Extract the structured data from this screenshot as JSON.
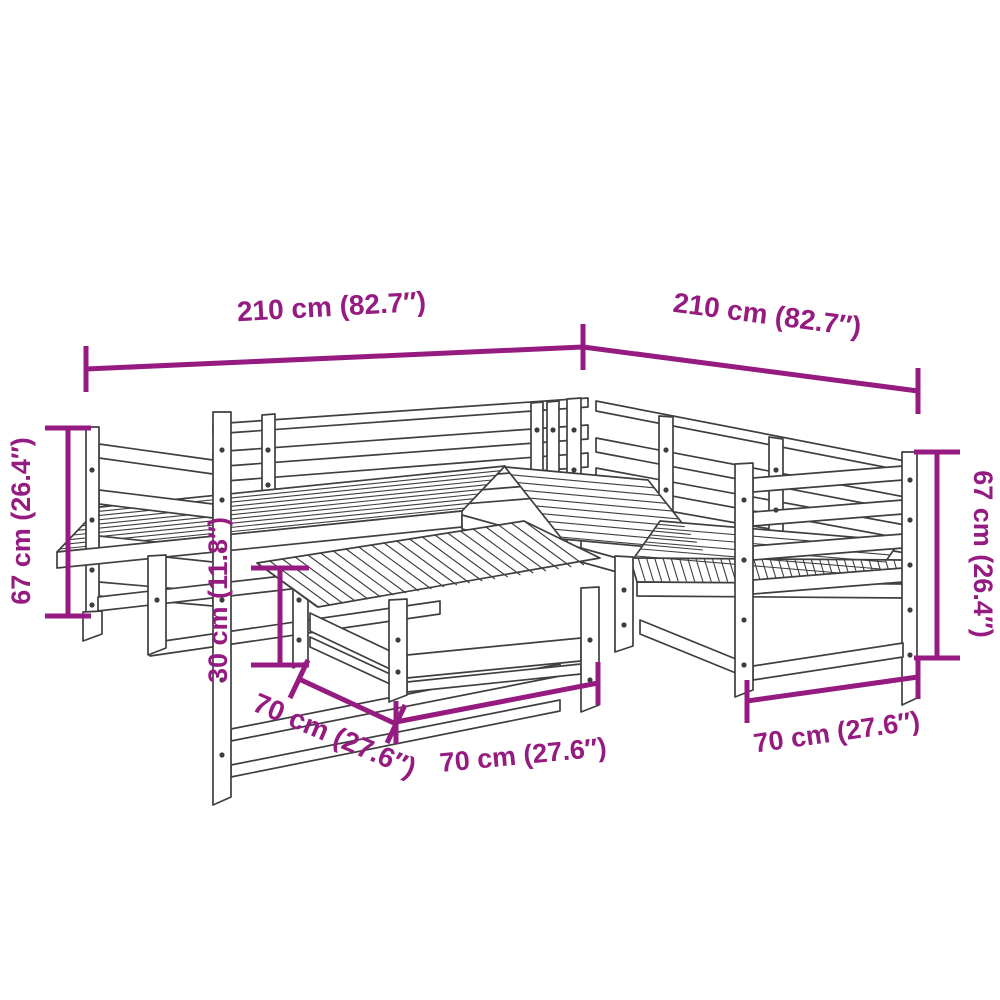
{
  "diagram": {
    "subject": "6-piece wooden garden sofa set with coffee table, isometric line drawing",
    "accent_color": "#951b81",
    "line_color": "#3f3f3f",
    "background": "#ffffff",
    "dimensions": {
      "back_width_left": "210 cm (82.7″)",
      "back_width_right": "210 cm (82.7″)",
      "height_left": "67 cm (26.4″)",
      "height_right": "67 cm (26.4″)",
      "table_height": "30 cm (11.8″)",
      "table_depth": "70 cm (27.6″)",
      "table_width": "70 cm (27.6″)",
      "seat_width": "70 cm (27.6″)"
    }
  }
}
